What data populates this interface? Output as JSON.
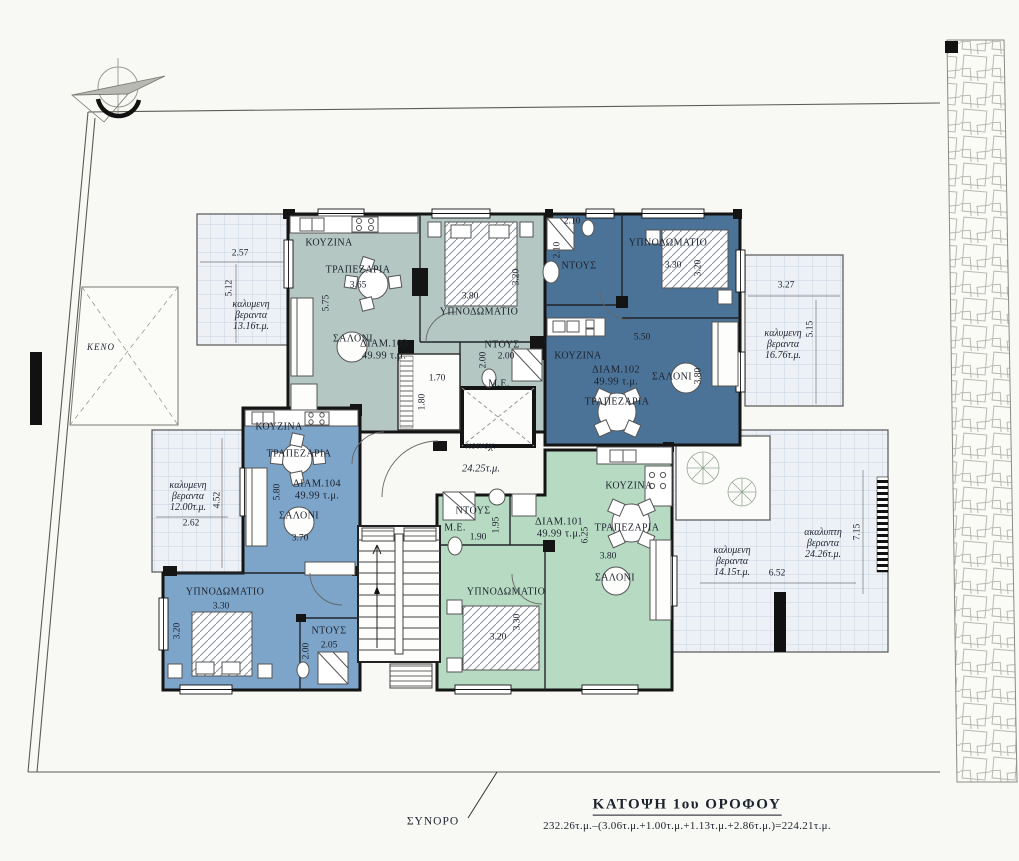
{
  "site": {
    "void_label": "ΚΕΝΟ",
    "boundary_label": "ΣΥΝΟΡΟ",
    "north_icon": "compass-north-arrow",
    "wall_texture": "stone-boundary-wall"
  },
  "title_block": {
    "title": "ΚΑΤΟΨΗ 1ου ΟΡΟΦΟΥ",
    "formula": "232.26τ.μ.–(3.06τ.μ.+1.00τ.μ.+1.13τ.μ.+2.86τ.μ.)=224.21τ.μ."
  },
  "common": {
    "label": "κοινοχ.",
    "area": "24.25τ.μ."
  },
  "apartments": [
    {
      "id": "ΔΙΑΜ.103",
      "area": "49.99 τ.μ.",
      "color": "#b4c7c2",
      "lx": 384,
      "ly": 350
    },
    {
      "id": "ΔΙΑΜ.102",
      "area": "49.99 τ.μ.",
      "color": "#4b7398",
      "lx": 616,
      "ly": 376
    },
    {
      "id": "ΔΙΑΜ.104",
      "area": "49.99 τ.μ.",
      "color": "#7da4c9",
      "lx": 317,
      "ly": 490
    },
    {
      "id": "ΔΙΑΜ.101",
      "area": "49.99 τ.μ.",
      "color": "#b7dac2",
      "lx": 559,
      "ly": 528
    }
  ],
  "rooms": [
    {
      "text": "ΚΟΥΖΙΝΑ",
      "x": 329,
      "y": 243
    },
    {
      "text": "ΤΡΑΠΕΖΑΡΙΑ",
      "x": 358,
      "y": 270
    },
    {
      "text": "ΣΑΛΟΝΙ",
      "x": 353,
      "y": 339
    },
    {
      "text": "ΥΠΝΟΔΩΜΑΤΙΟ",
      "x": 479,
      "y": 312
    },
    {
      "text": "ΝΤΟΥΣ",
      "x": 502,
      "y": 345
    },
    {
      "text": "Μ.Ε.",
      "x": 499,
      "y": 384
    },
    {
      "text": "ΝΤΟΥΣ",
      "x": 579,
      "y": 266
    },
    {
      "text": "ΥΠΝΟΔΩΜΑΤΙΟ",
      "x": 668,
      "y": 243
    },
    {
      "text": "ΚΟΥΖΙΝΑ",
      "x": 578,
      "y": 356
    },
    {
      "text": "ΣΑΛΟΝΙ",
      "x": 672,
      "y": 377
    },
    {
      "text": "ΤΡΑΠΕΖΑΡΙΑ",
      "x": 617,
      "y": 402
    },
    {
      "text": "ΚΟΥΖΙΝΑ",
      "x": 279,
      "y": 427
    },
    {
      "text": "ΤΡΑΠΕΖΑΡΙΑ",
      "x": 299,
      "y": 454
    },
    {
      "text": "ΣΑΛΟΝΙ",
      "x": 299,
      "y": 516
    },
    {
      "text": "ΥΠΝΟΔΩΜΑΤΙΟ",
      "x": 225,
      "y": 592
    },
    {
      "text": "ΝΤΟΥΣ",
      "x": 329,
      "y": 631
    },
    {
      "text": "ΚΟΥΖΙΝΑ",
      "x": 629,
      "y": 486
    },
    {
      "text": "ΤΡΑΠΕΖΑΡΙΑ",
      "x": 627,
      "y": 528
    },
    {
      "text": "ΣΑΛΟΝΙ",
      "x": 615,
      "y": 578
    },
    {
      "text": "ΥΠΝΟΔΩΜΑΤΙΟ",
      "x": 506,
      "y": 592
    },
    {
      "text": "ΝΤΟΥΣ",
      "x": 473,
      "y": 511
    },
    {
      "text": "Μ.Ε.",
      "x": 455,
      "y": 528
    }
  ],
  "dimensions": [
    {
      "text": "3.65",
      "x": 358,
      "y": 286
    },
    {
      "text": "5.75",
      "x": 327,
      "y": 303,
      "rot": true
    },
    {
      "text": "3.80",
      "x": 470,
      "y": 297
    },
    {
      "text": "3.20",
      "x": 517,
      "y": 277,
      "rot": true
    },
    {
      "text": "2.00",
      "x": 506,
      "y": 357
    },
    {
      "text": "2.00",
      "x": 484,
      "y": 360,
      "rot": true
    },
    {
      "text": "1.70",
      "x": 437,
      "y": 379
    },
    {
      "text": "1.80",
      "x": 423,
      "y": 402,
      "rot": true
    },
    {
      "text": "2.10",
      "x": 572,
      "y": 222
    },
    {
      "text": "2.10",
      "x": 558,
      "y": 250,
      "rot": true
    },
    {
      "text": "3.30",
      "x": 673,
      "y": 266
    },
    {
      "text": "3.20",
      "x": 699,
      "y": 268,
      "rot": true
    },
    {
      "text": "5.50",
      "x": 642,
      "y": 338
    },
    {
      "text": "3.80",
      "x": 699,
      "y": 376,
      "rot": true
    },
    {
      "text": "5.80",
      "x": 278,
      "y": 492,
      "rot": true
    },
    {
      "text": "3.70",
      "x": 300,
      "y": 539
    },
    {
      "text": "3.30",
      "x": 221,
      "y": 607
    },
    {
      "text": "3.20",
      "x": 178,
      "y": 631,
      "rot": true
    },
    {
      "text": "2.05",
      "x": 329,
      "y": 646
    },
    {
      "text": "2.00",
      "x": 307,
      "y": 651,
      "rot": true
    },
    {
      "text": "1.95",
      "x": 497,
      "y": 525,
      "rot": true
    },
    {
      "text": "1.90",
      "x": 478,
      "y": 538
    },
    {
      "text": "6.25",
      "x": 586,
      "y": 535,
      "rot": true
    },
    {
      "text": "3.80",
      "x": 608,
      "y": 557
    },
    {
      "text": "3.20",
      "x": 498,
      "y": 638
    },
    {
      "text": "3.30",
      "x": 518,
      "y": 622,
      "rot": true
    },
    {
      "text": "2.57",
      "x": 240,
      "y": 254
    },
    {
      "text": "5.12",
      "x": 230,
      "y": 288,
      "rot": true
    },
    {
      "text": "2.62",
      "x": 191,
      "y": 524
    },
    {
      "text": "4.52",
      "x": 218,
      "y": 500,
      "rot": true
    },
    {
      "text": "3.27",
      "x": 786,
      "y": 286
    },
    {
      "text": "5.15",
      "x": 811,
      "y": 329,
      "rot": true
    },
    {
      "text": "6.52",
      "x": 777,
      "y": 574
    },
    {
      "text": "7.15",
      "x": 858,
      "y": 532,
      "rot": true
    }
  ],
  "verandas": [
    {
      "text": "καλυμενη\nβεραντα\n13.16τ.μ.",
      "x": 251,
      "y": 316
    },
    {
      "text": "καλυμενη\nβεραντα\n12.00τ.μ.",
      "x": 188,
      "y": 497
    },
    {
      "text": "καλυμενη\nβεραντα\n16.76τ.μ.",
      "x": 783,
      "y": 345
    },
    {
      "text": "καλυμενη\nβεραντα\n14.15τ.μ.",
      "x": 732,
      "y": 562
    },
    {
      "text": "ακαλυπτη\nβεραντα\n24.26τ.μ.",
      "x": 823,
      "y": 544
    }
  ]
}
